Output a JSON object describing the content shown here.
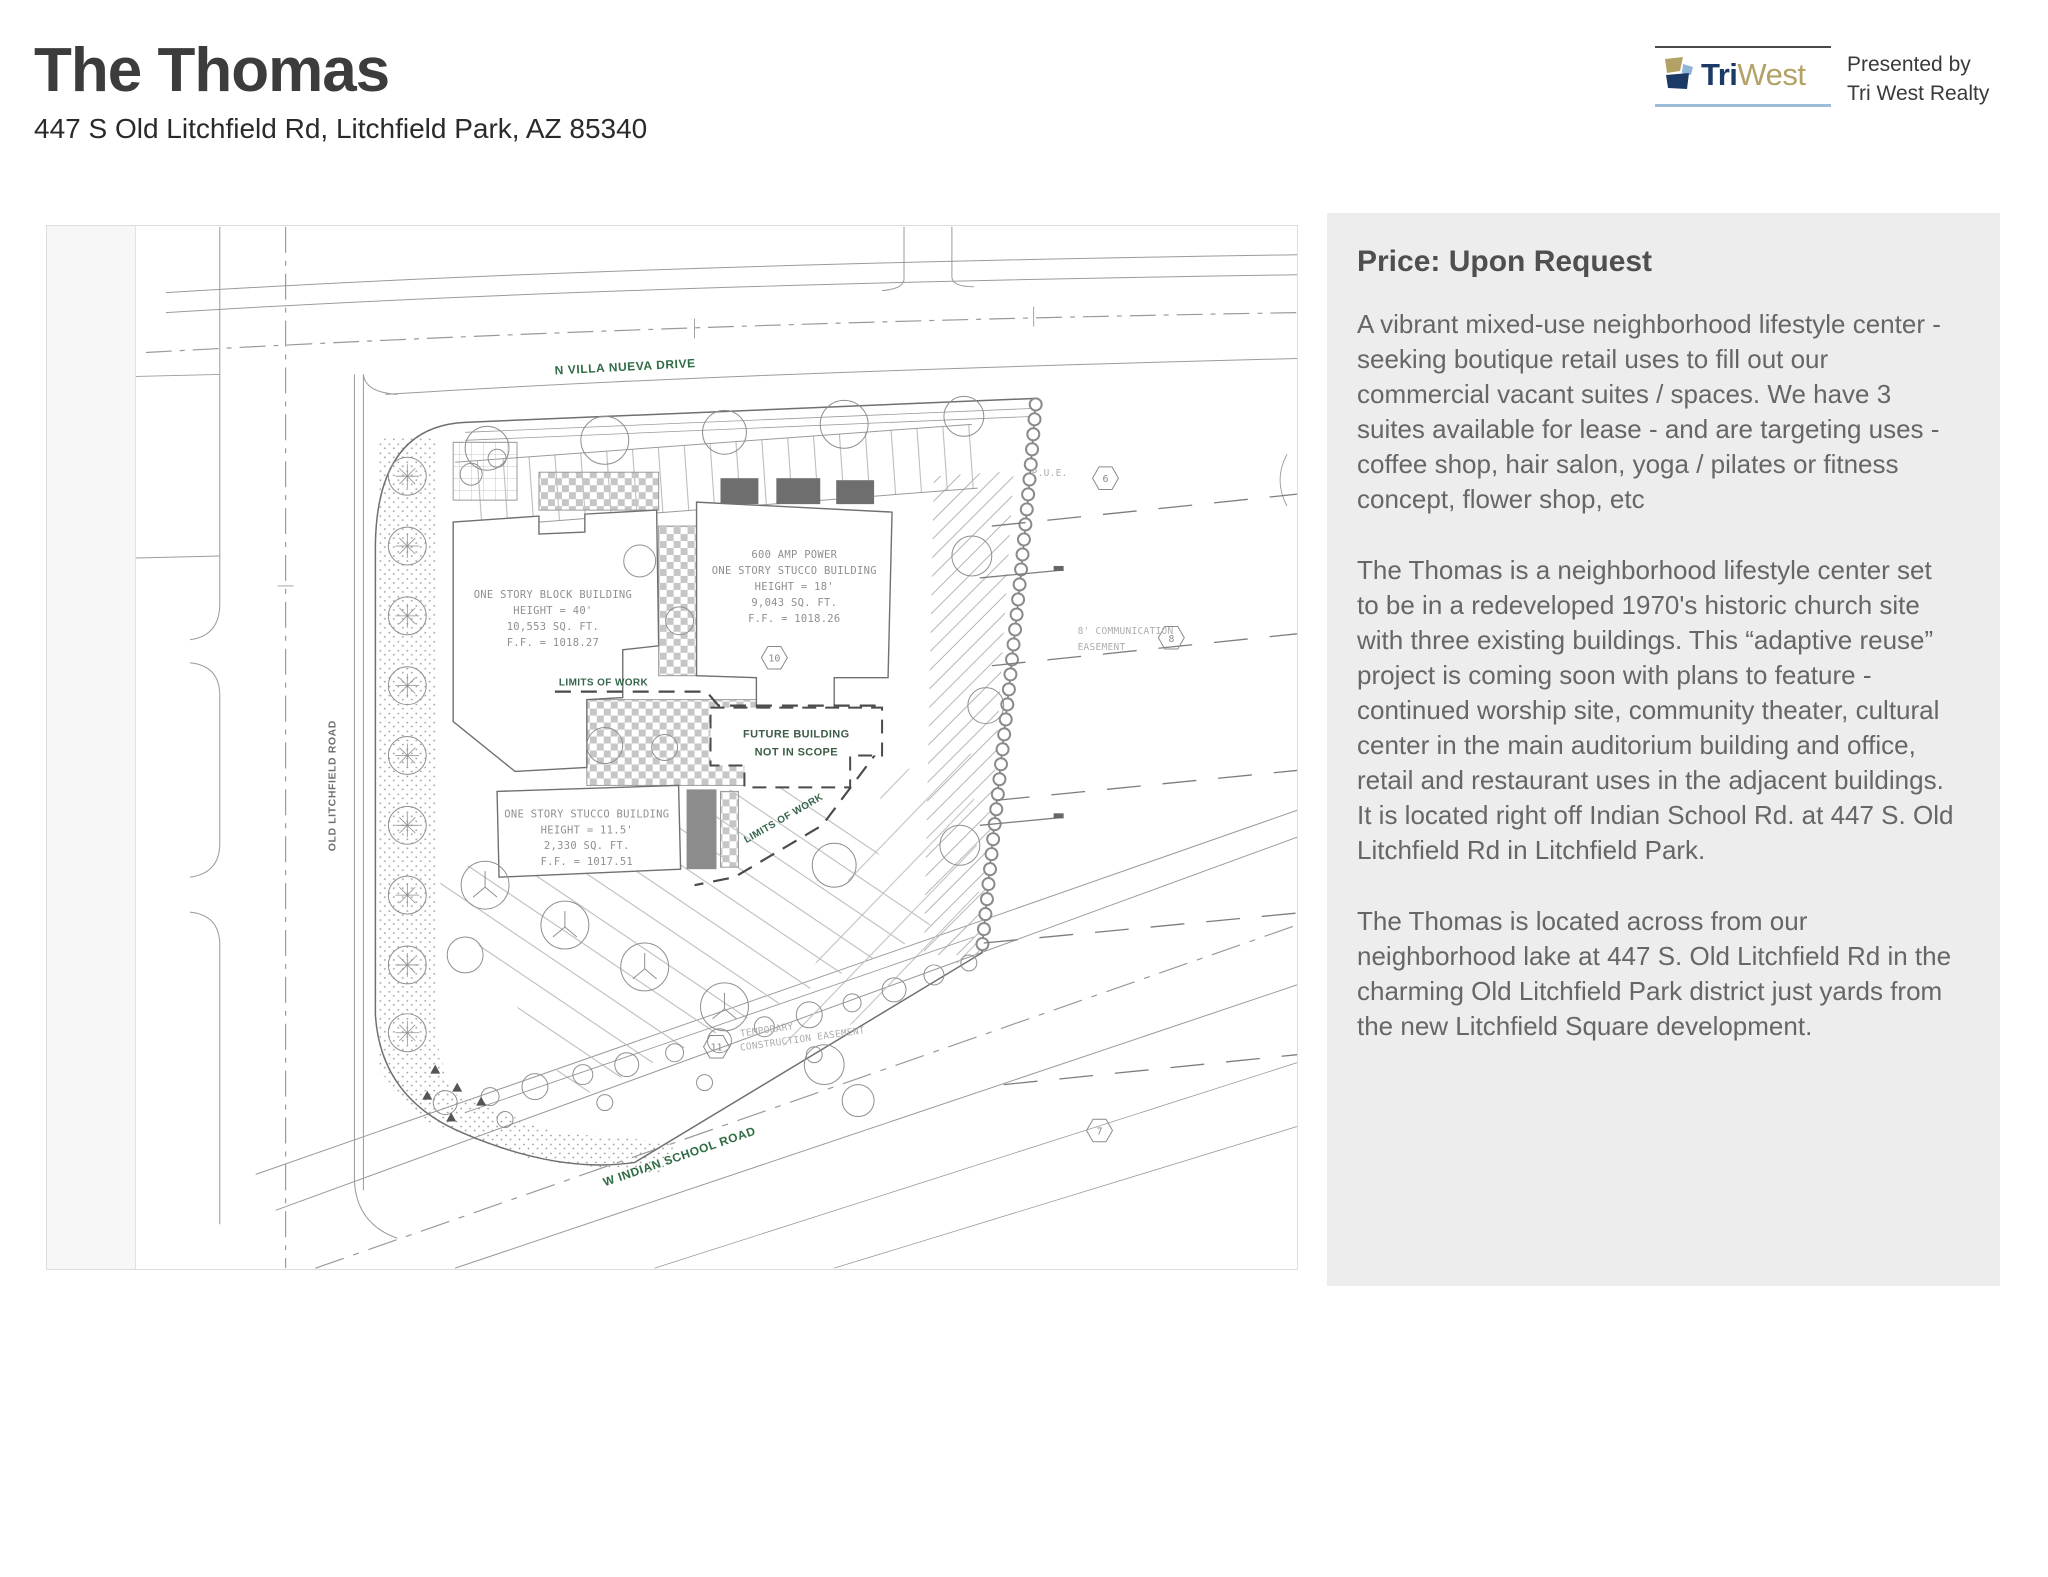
{
  "page": {
    "title": "The Thomas",
    "address": "447 S Old Litchfield Rd, Litchfield Park, AZ 85340"
  },
  "branding": {
    "logo_tri": "Tri",
    "logo_west": "West",
    "presented_line1": "Presented by",
    "presented_line2": "Tri West Realty",
    "brand_navy": "#1c3a66",
    "brand_gold": "#b3a266",
    "brand_lightblue": "#9dbcd8"
  },
  "listing": {
    "price_heading": "Price: Upon Request",
    "paragraphs": [
      "A vibrant mixed-use neighborhood lifestyle center - seeking boutique retail uses to fill out our commercial vacant suites / spaces. We have 3 suites available for lease - and are targeting uses - coffee shop, hair salon, yoga / pilates or fitness concept, flower shop, etc",
      "The Thomas is a neighborhood lifestyle center set to be in a redeveloped 1970's historic church site with three existing buildings. This “adaptive reuse” project is coming soon with plans to feature - continued worship site, community theater, cultural center in the main auditorium building and office, retail and restaurant uses in the adjacent buildings. It is located right off Indian School Rd. at 447 S. Old Litchfield Rd in Litchfield Park.",
      "The Thomas is located across from our neighborhood lake at 447 S. Old Litchfield Rd in the charming Old Litchfield Park district just yards from the new Litchfield Square development."
    ]
  },
  "plan": {
    "streets": {
      "top": "N VILLA NUEVA DRIVE",
      "left": "OLD LITCHFIELD ROAD",
      "bottom": "W INDIAN SCHOOL ROAD"
    },
    "buildings": {
      "block": [
        "ONE STORY BLOCK BUILDING",
        "HEIGHT = 40'",
        "10,553 SQ. FT.",
        "F.F. = 1018.27"
      ],
      "stucco_main": [
        "600 AMP POWER",
        "ONE STORY STUCCO BUILDING",
        "HEIGHT = 18'",
        "9,043 SQ. FT.",
        "F.F. = 1018.26"
      ],
      "stucco_small": [
        "ONE STORY STUCCO BUILDING",
        "HEIGHT = 11.5'",
        "2,330 SQ. FT.",
        "F.F. = 1017.51"
      ],
      "future": [
        "FUTURE BUILDING",
        "NOT IN SCOPE"
      ]
    },
    "labels": {
      "limits": "LIMITS OF WORK",
      "easement1": "8' COMMUNICATION",
      "easement2": "EASEMENT",
      "pue": "P.U.E.",
      "temp1": "TEMPORARY",
      "temp2": "CONSTRUCTION EASEMENT"
    },
    "keynotes": {
      "k6": "6",
      "k7": "7",
      "k8": "8",
      "k10": "10",
      "k11": "11"
    },
    "colors": {
      "plan_green": "#2f6b45",
      "drawing_gray": "#9a9a9a",
      "panel_gray": "#ededed"
    }
  }
}
